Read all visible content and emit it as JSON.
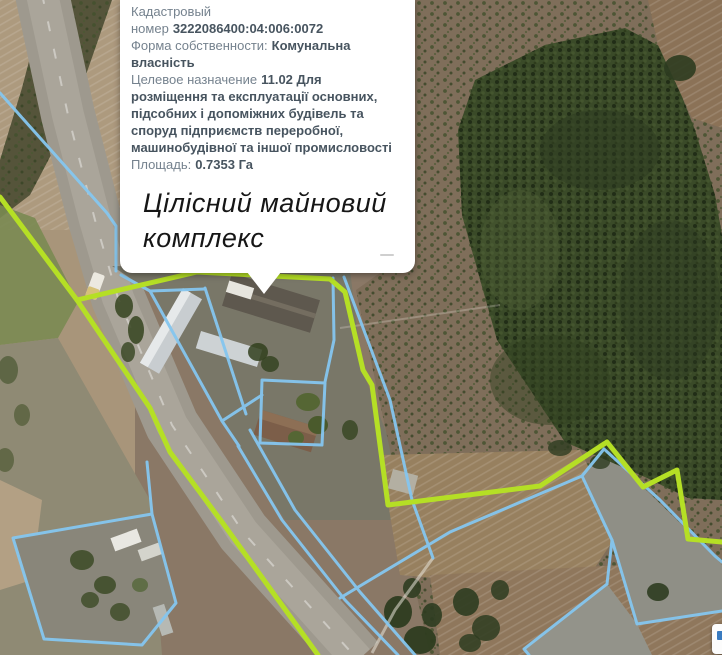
{
  "popup": {
    "fields": [
      {
        "label": "Кадастровый номер",
        "value": "3222086400:04:006:0072"
      },
      {
        "label": "Форма собственности:",
        "value": "Комунальна власність"
      },
      {
        "label": "Целевое назначение",
        "value": "11.02 Для розміщення та експлуатації основних, підсобних і допоміжних будівель та споруд підприємств переробної, машинобудівної та іншої промисловості"
      },
      {
        "label": "Площадь:",
        "value": "0.7353 Га"
      }
    ],
    "annotation": "Цілісний майновий комплекс"
  },
  "map": {
    "colors": {
      "parcel_boundary": "#85c6ef",
      "highlighted_boundary": "#b5df25",
      "forest": "#3a4a28",
      "road": "#9e998e",
      "cleared_pad": "#8f8f86"
    }
  }
}
